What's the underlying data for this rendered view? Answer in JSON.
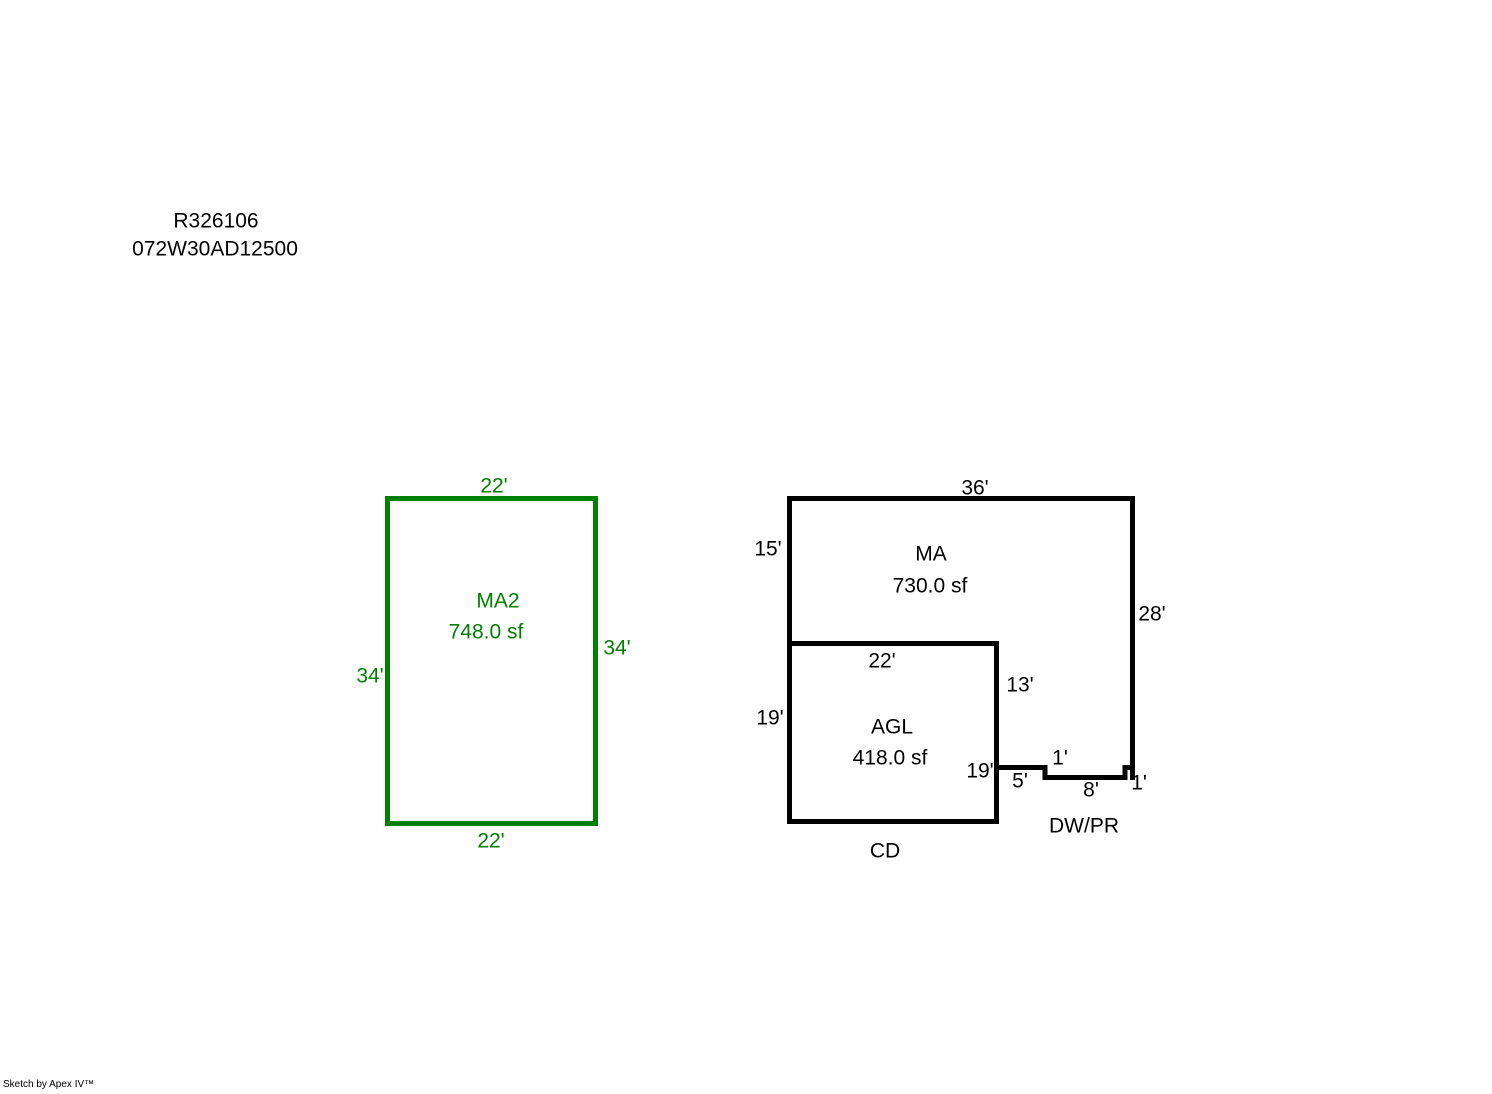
{
  "header": {
    "line1": "R326106",
    "line2": "072W30AD12500"
  },
  "sections": {
    "ma2": {
      "label": "MA2",
      "area": "748.0 sf",
      "dims": {
        "top": "22'",
        "left": "34'",
        "right": "34'",
        "bottom": "22'"
      }
    },
    "ma": {
      "label": "MA",
      "area": "730.0 sf",
      "dims": {
        "top": "36'",
        "left": "15'",
        "right": "28'"
      }
    },
    "agl": {
      "label": "AGL",
      "area": "418.0 sf",
      "dims": {
        "top": "22'",
        "left": "19'",
        "right_upper": "13'",
        "right_lower": "19'"
      }
    },
    "dwpr": {
      "label": "DW/PR",
      "dims": {
        "left": "5'",
        "step_down": "1'",
        "bottom": "8'",
        "step_up": "1'"
      }
    },
    "cd": {
      "label": "CD"
    }
  },
  "footer": {
    "credit": "Sketch by Apex IV™"
  },
  "colors": {
    "ma2_outline": "#008000",
    "main_outline": "#000000",
    "background": "#ffffff"
  }
}
